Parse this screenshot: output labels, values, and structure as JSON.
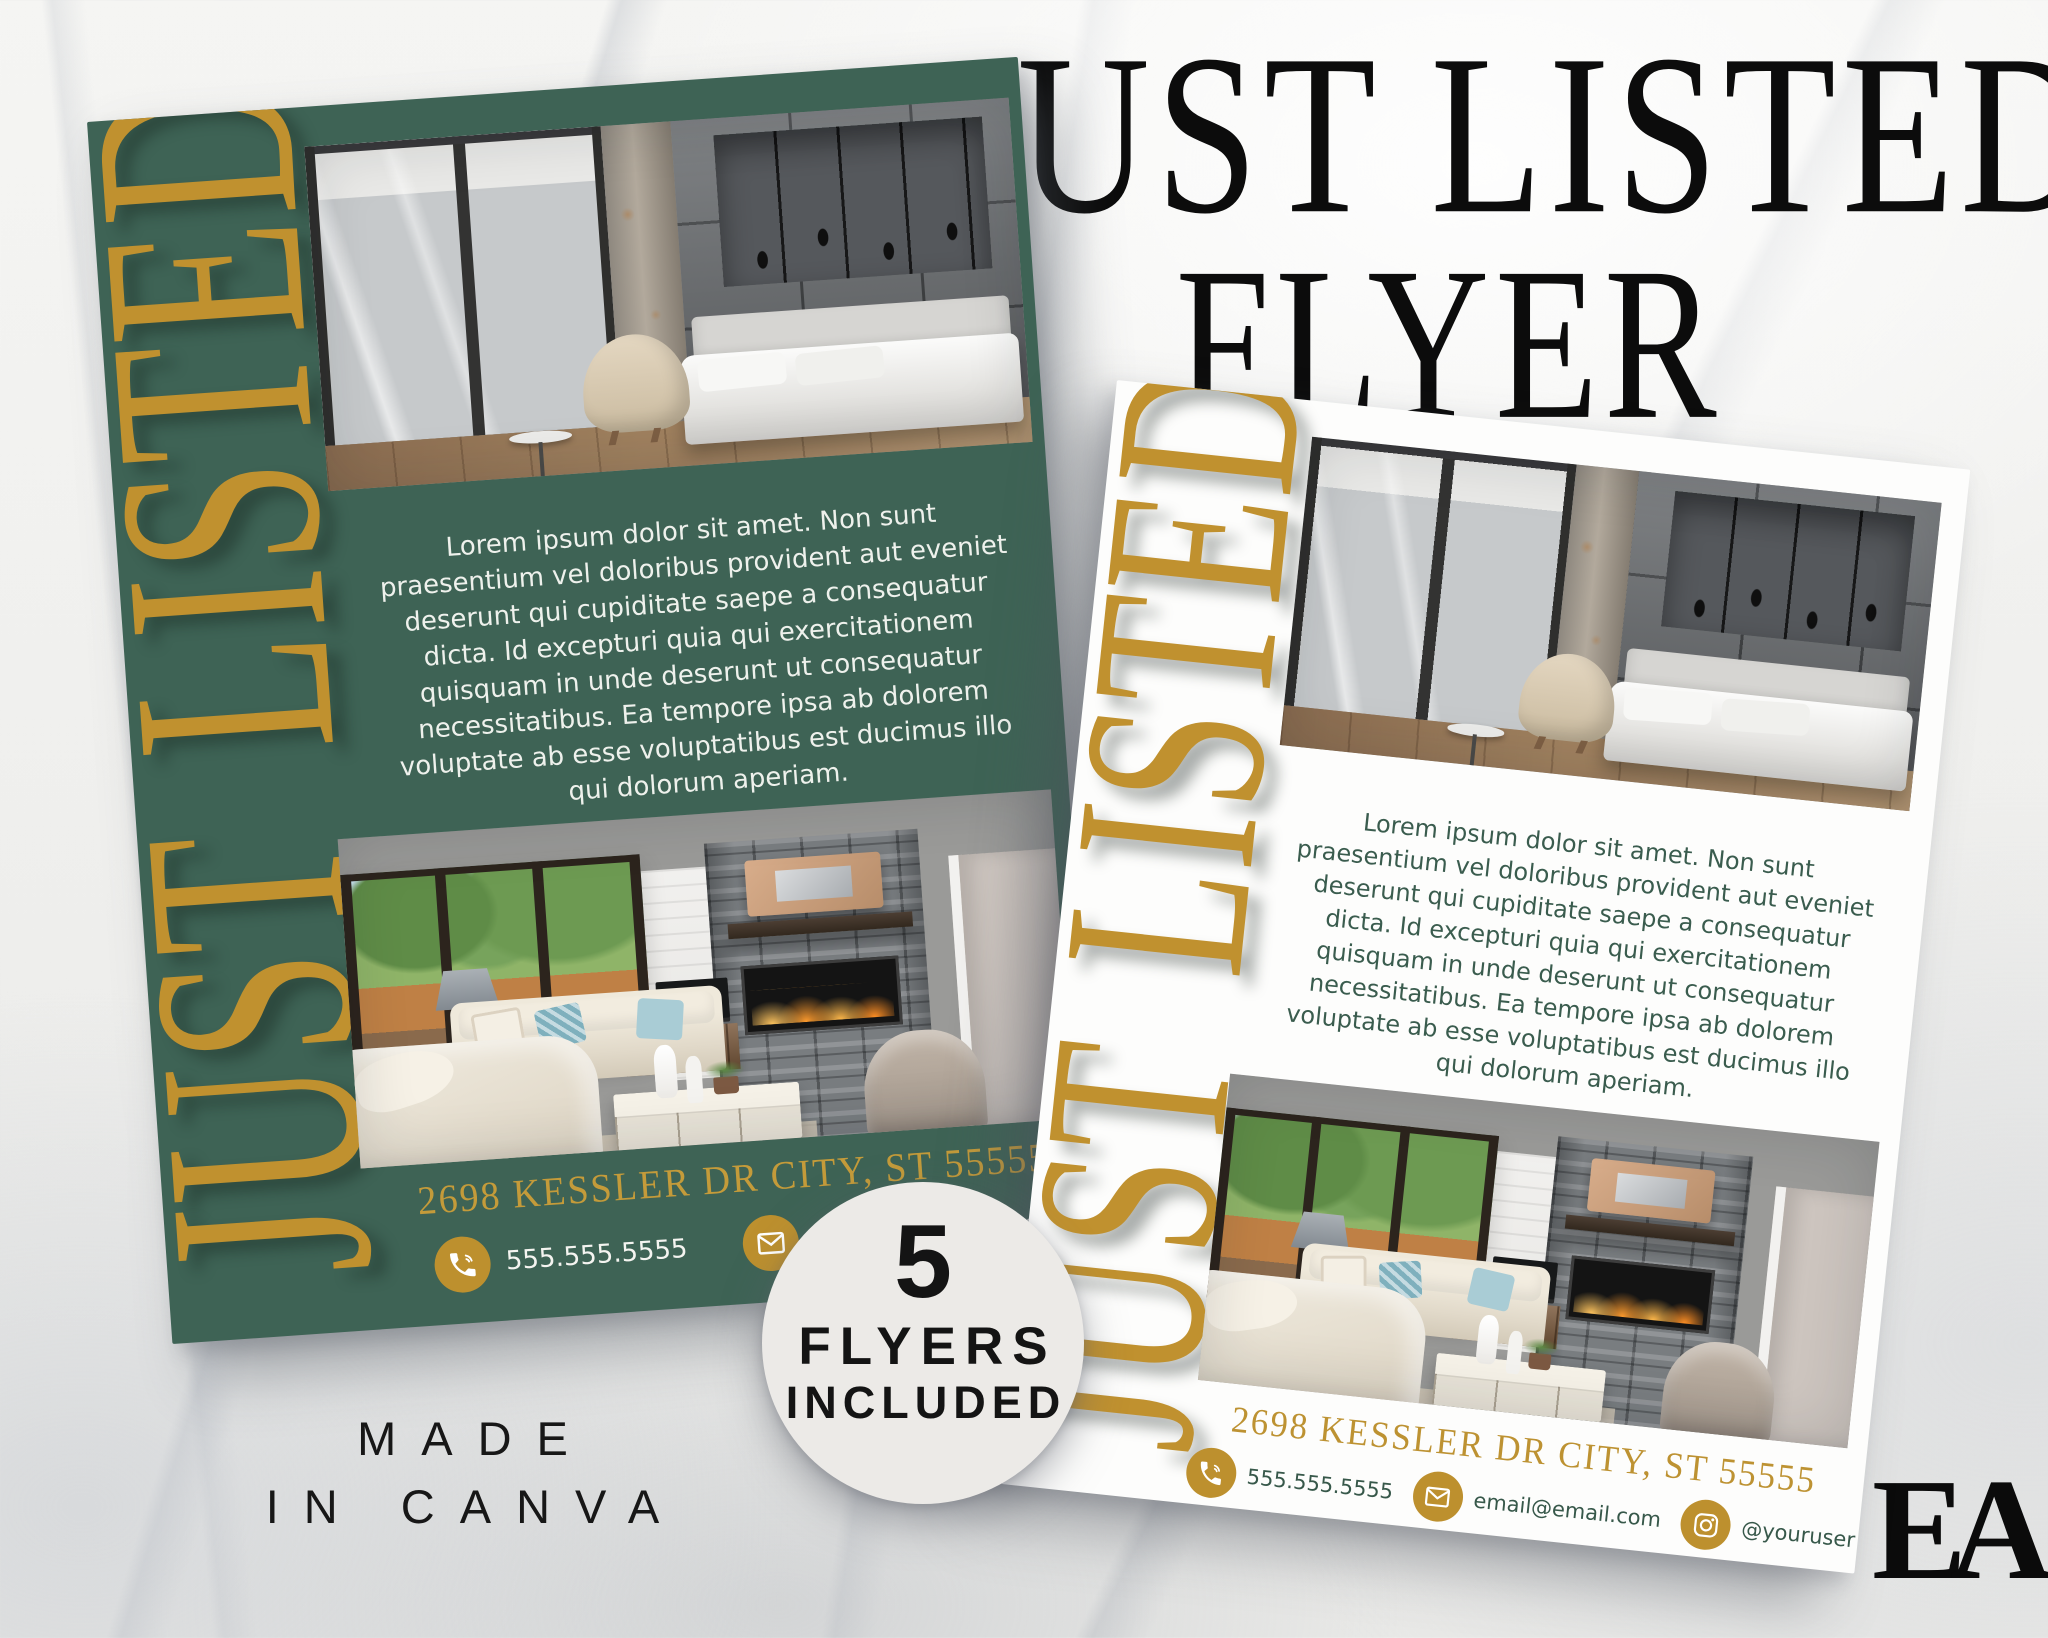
{
  "header": {
    "title_line1": "JUST LISTED",
    "title_line2": "FLYER"
  },
  "badge": {
    "count": "5",
    "line1": "FLYERS",
    "line2": "INCLUDED"
  },
  "watermark": {
    "line1": "MADE",
    "line2": "IN CANVA"
  },
  "logo": {
    "text": "EA"
  },
  "colors": {
    "flyer_green": "#3E6355",
    "gold": "#C0912F",
    "gold_address": "#C49B3A",
    "text_on_green": "#EEF1EC",
    "text_on_white": "#3A5C4E",
    "badge_bg": "#ECEAE7",
    "headline_black": "#0C0C0C"
  },
  "flyers": {
    "left": {
      "vertical_label": "JUST LISTED",
      "body": "Lorem ipsum dolor sit amet. Non sunt praesentium vel doloribus provident aut eveniet deserunt qui cupiditate saepe a consequatur dicta. Id excepturi quia qui exercitationem quisquam in unde deserunt ut consequatur necessitatibus. Ea tempore ipsa ab dolorem voluptate ab esse voluptatibus est ducimus illo qui dolorum aperiam.",
      "address": "2698 KESSLER DR CITY, ST 55555",
      "contacts": [
        {
          "icon": "phone-icon",
          "label": "555.555.5555"
        },
        {
          "icon": "email-icon",
          "label": "email@email.com"
        }
      ],
      "photos": {
        "top": "bedroom-photo",
        "bottom": "living-room-photo"
      }
    },
    "right": {
      "vertical_label": "JUST LISTED",
      "body": "Lorem ipsum dolor sit amet. Non sunt praesentium vel doloribus provident aut eveniet deserunt qui cupiditate saepe a consequatur dicta. Id excepturi quia qui exercitationem quisquam in unde deserunt ut consequatur necessitatibus. Ea tempore ipsa ab dolorem voluptate ab esse voluptatibus est ducimus illo qui dolorum aperiam.",
      "address": "2698 KESSLER DR CITY, ST 55555",
      "contacts": [
        {
          "icon": "phone-icon",
          "label": "555.555.5555"
        },
        {
          "icon": "email-icon",
          "label": "email@email.com"
        },
        {
          "icon": "instagram-icon",
          "label": "@youruser"
        }
      ],
      "photos": {
        "top": "bedroom-photo",
        "bottom": "living-room-photo"
      }
    }
  }
}
